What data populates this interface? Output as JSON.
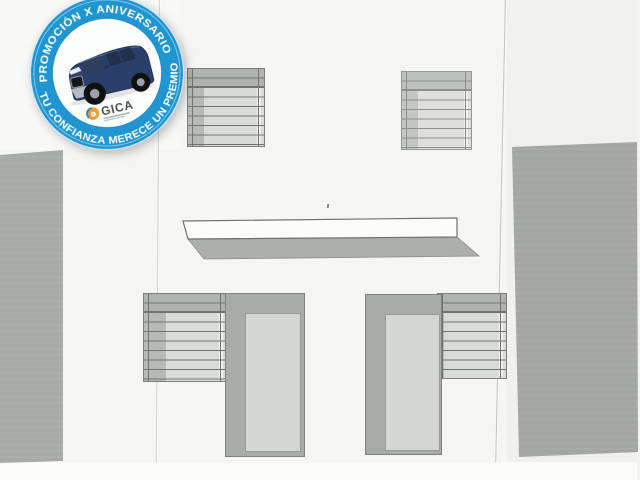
{
  "badge": {
    "arc_text_top": "PROMOCIÓN X ANIVERSARIO",
    "arc_text_bottom": "TU CONFIANZA MERECE UN PREMIO",
    "brand_name": "GICA",
    "colors": {
      "ring": "#1f96d2",
      "inner": "#fcfdfd",
      "arc_text": "#ffffff",
      "car_body": "#2b3f6b",
      "logo_orange": "#f39c2d",
      "logo_blue": "#2f7fc1"
    }
  },
  "drawing": {
    "kind": "building facade elevation, scanned drawing",
    "colors": {
      "paper": "#f5f5f1",
      "side_wall": "#a8aaa4",
      "shutter_light": "#d9dbd5",
      "shutter_band": "#b0b3ad",
      "door_frame": "#a9aba5",
      "door_panel": "#d4d6d0",
      "outline": "#70746e",
      "canopy_face": "#fcfcfa",
      "canopy_underside": "#adb0aa"
    }
  }
}
